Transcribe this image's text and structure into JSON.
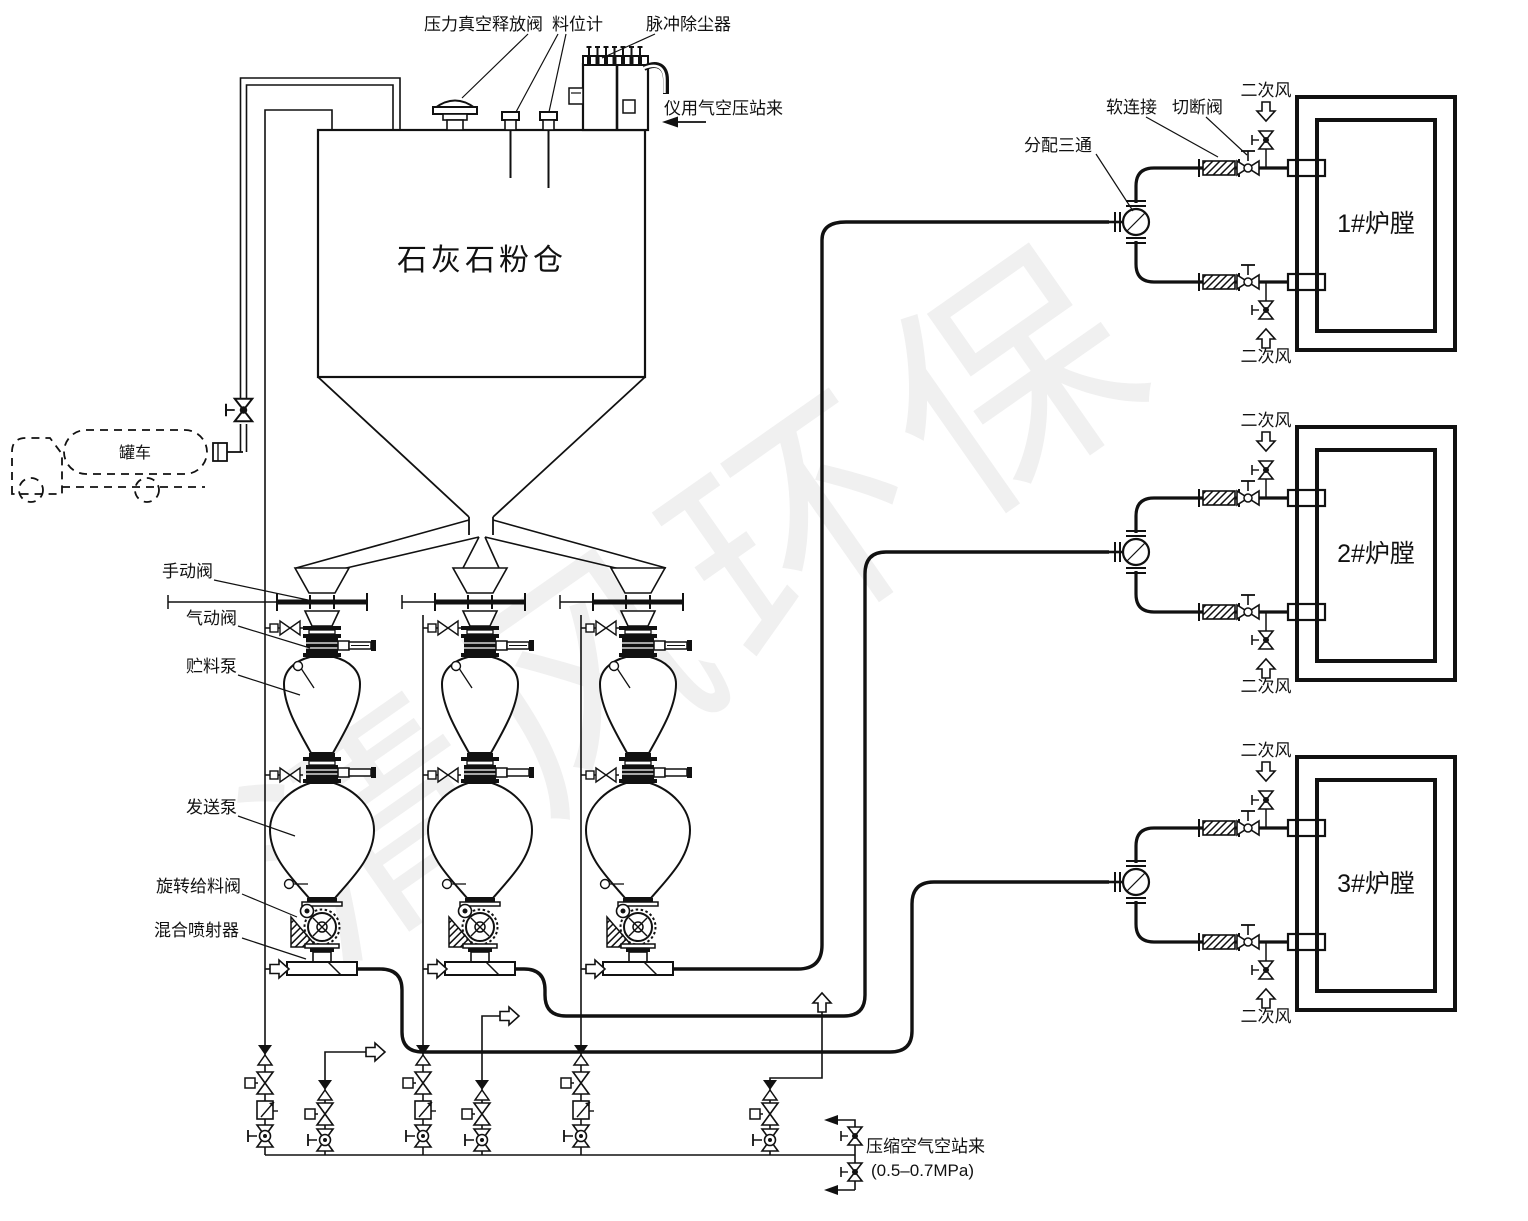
{
  "watermark": "清风环保",
  "silo": {
    "label": "石灰石粉仓"
  },
  "truck": {
    "label": "罐车"
  },
  "top_labels": {
    "pvrv": "压力真空释放阀",
    "level_gauge": "料位计",
    "pulse_filter": "脉冲除尘器",
    "instrument_air": "仪用气空压站来"
  },
  "train_labels": {
    "manual_valve": "手动阀",
    "pneumatic_valve": "气动阀",
    "storage_pump": "贮料泵",
    "sending_pump": "发送泵",
    "rotary_feeder": "旋转给料阀",
    "mixing_ejector": "混合喷射器"
  },
  "distribution": {
    "tee_label": "分配三通",
    "soft_connection_label": "软连接",
    "cutoff_valve_label": "切断阀",
    "secondary_air_label": "二次风"
  },
  "furnaces": [
    {
      "label": "1#炉膛"
    },
    {
      "label": "2#炉膛"
    },
    {
      "label": "3#炉膛"
    }
  ],
  "air_supply": {
    "source_label": "压缩空气空站来",
    "pressure_label": "(0.5–0.7MPa)"
  }
}
